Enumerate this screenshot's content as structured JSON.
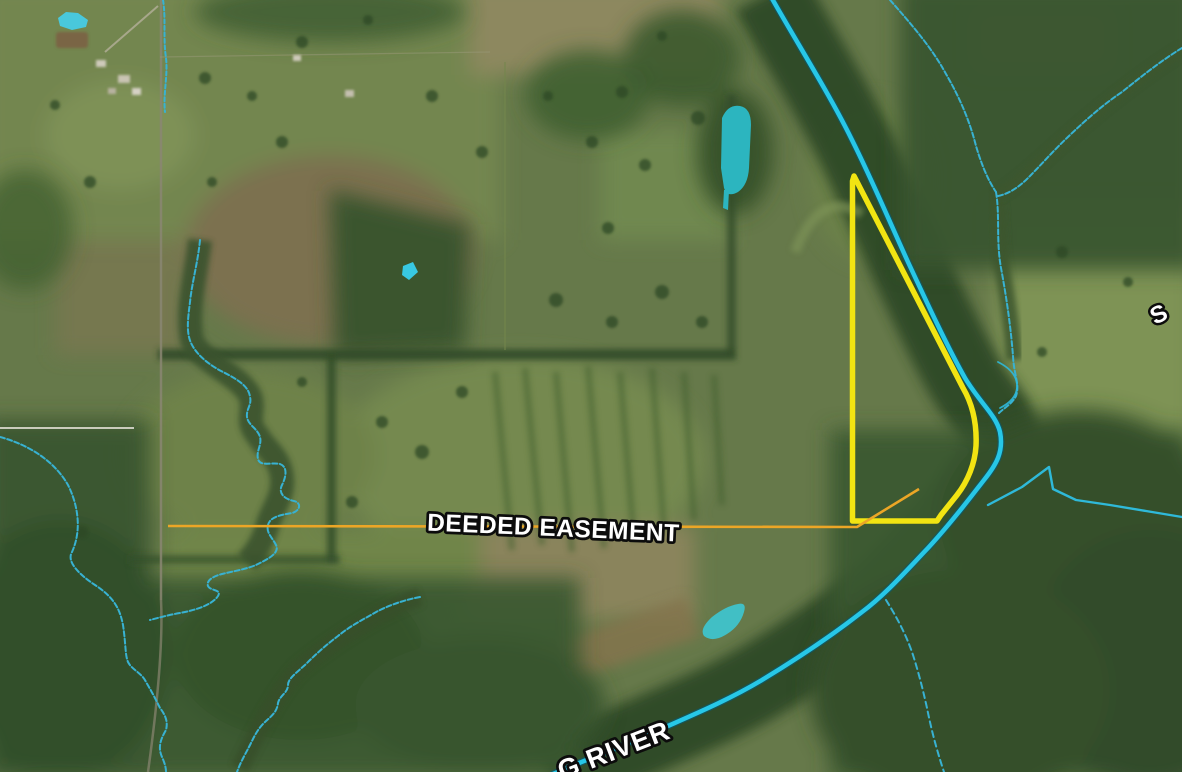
{
  "map": {
    "view": "satellite-aerial-map",
    "labels": {
      "easement": "DEEDED EASEMENT",
      "river": "G RIVER",
      "stream_partial": "S"
    },
    "colors": {
      "water_bright": "#27c7e7",
      "stream": "#38b2d2",
      "parcel_boundary": "#f2e412",
      "easement_line": "#eca626",
      "label_fill": "#ffffff",
      "label_outline": "#0d0d0d"
    },
    "features": {
      "parcel": "yellow property boundary polygon along river",
      "easement": "deeded easement line running west from parcel",
      "river": "large river flowing from top through right bend to bottom left",
      "ponds": 4
    }
  }
}
